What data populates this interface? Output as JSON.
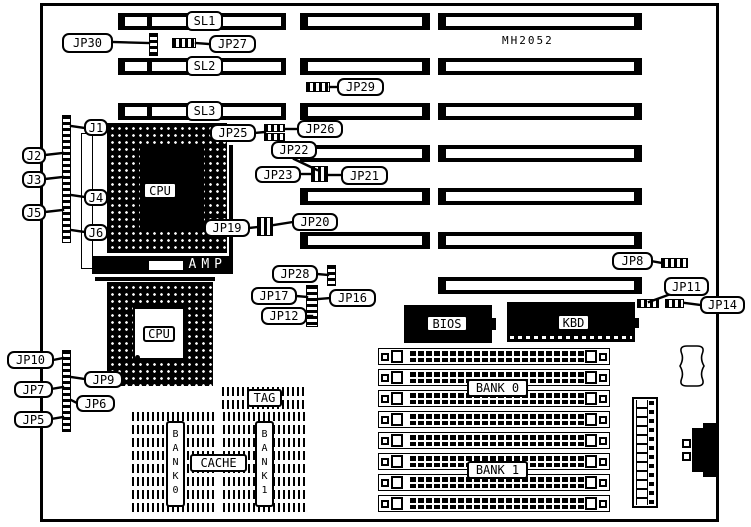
{
  "chips": {
    "model": "MH2052",
    "cpu1": "CPU",
    "cpu2": "CPU",
    "amp": "AMP",
    "bios": "BIOS",
    "kbd": "KBD",
    "tag": "TAG",
    "cache": "CACHE",
    "bank0_cache": "BANK0",
    "bank1_cache": "BANK1",
    "bank0_mem": "BANK 0",
    "bank1_mem": "BANK 1"
  },
  "diagram": {
    "slots": {
      "vlb": {
        "x": 118,
        "w": 168,
        "h": 17,
        "rows": [
          13,
          58,
          103
        ],
        "labels": [
          "SL1",
          "SL2",
          "SL3"
        ],
        "label_x": 186
      },
      "mid": {
        "x": 300,
        "w": 130,
        "h": 17,
        "rows": [
          13,
          58,
          103,
          145,
          188,
          232
        ]
      },
      "right": {
        "x": 438,
        "w": 204,
        "h": 17,
        "rows": [
          13,
          58,
          103,
          145,
          188,
          232,
          277
        ]
      }
    },
    "simms": {
      "x": 378,
      "w": 232,
      "h": 17,
      "rows": [
        348,
        369,
        390,
        411,
        432,
        453,
        474,
        495
      ]
    },
    "jumpers": [
      {
        "id": "jp30",
        "x": 149,
        "y": 33,
        "w": 9,
        "h": 23,
        "dir": "v"
      },
      {
        "id": "jp27",
        "x": 172,
        "y": 38,
        "w": 24,
        "h": 10,
        "dir": "h"
      },
      {
        "id": "jp29",
        "x": 306,
        "y": 82,
        "w": 24,
        "h": 10,
        "dir": "h"
      },
      {
        "id": "jp25-jp26-a",
        "x": 264,
        "y": 124,
        "w": 21,
        "h": 8,
        "dir": "h"
      },
      {
        "id": "jp25-jp26-b",
        "x": 264,
        "y": 133,
        "w": 21,
        "h": 8,
        "dir": "h"
      },
      {
        "id": "jp23-jp21",
        "x": 311,
        "y": 166,
        "w": 17,
        "h": 16,
        "dir": "h"
      },
      {
        "id": "jp19-jp20",
        "x": 257,
        "y": 217,
        "w": 16,
        "h": 19,
        "dir": "h"
      },
      {
        "id": "jp28",
        "x": 327,
        "y": 265,
        "w": 9,
        "h": 21,
        "dir": "v"
      },
      {
        "id": "jp17-jp16-jp12",
        "x": 306,
        "y": 285,
        "w": 12,
        "h": 42,
        "dir": "v"
      },
      {
        "id": "jp8",
        "x": 661,
        "y": 258,
        "w": 27,
        "h": 10,
        "dir": "h"
      },
      {
        "id": "jp11",
        "x": 637,
        "y": 299,
        "w": 22,
        "h": 9,
        "dir": "h"
      },
      {
        "id": "jp14",
        "x": 665,
        "y": 299,
        "w": 19,
        "h": 9,
        "dir": "h"
      },
      {
        "id": "j-header-column",
        "x": 62,
        "y": 115,
        "w": 9,
        "h": 128,
        "dir": "v"
      },
      {
        "id": "jp-header-column",
        "x": 62,
        "y": 350,
        "w": 9,
        "h": 82,
        "dir": "v"
      }
    ],
    "callouts": [
      {
        "text": "JP30",
        "x": 62,
        "y": 33,
        "w": 51,
        "h": 20
      },
      {
        "text": "JP27",
        "x": 209,
        "y": 35,
        "w": 47,
        "h": 18
      },
      {
        "text": "JP29",
        "x": 337,
        "y": 78,
        "w": 47,
        "h": 18
      },
      {
        "text": "JP26",
        "x": 297,
        "y": 120,
        "w": 46,
        "h": 18
      },
      {
        "text": "JP25",
        "x": 210,
        "y": 124,
        "w": 46,
        "h": 18
      },
      {
        "text": "JP22",
        "x": 271,
        "y": 141,
        "w": 46,
        "h": 18
      },
      {
        "text": "JP23",
        "x": 255,
        "y": 166,
        "w": 46,
        "h": 17
      },
      {
        "text": "JP21",
        "x": 341,
        "y": 166,
        "w": 47,
        "h": 19
      },
      {
        "text": "JP19",
        "x": 204,
        "y": 219,
        "w": 46,
        "h": 18
      },
      {
        "text": "JP20",
        "x": 292,
        "y": 213,
        "w": 46,
        "h": 18
      },
      {
        "text": "JP28",
        "x": 272,
        "y": 265,
        "w": 46,
        "h": 18
      },
      {
        "text": "JP17",
        "x": 251,
        "y": 287,
        "w": 46,
        "h": 18
      },
      {
        "text": "JP16",
        "x": 329,
        "y": 289,
        "w": 47,
        "h": 18
      },
      {
        "text": "JP12",
        "x": 261,
        "y": 307,
        "w": 46,
        "h": 18
      },
      {
        "text": "JP8",
        "x": 612,
        "y": 252,
        "w": 41,
        "h": 18
      },
      {
        "text": "JP11",
        "x": 664,
        "y": 277,
        "w": 45,
        "h": 19
      },
      {
        "text": "JP14",
        "x": 700,
        "y": 296,
        "w": 45,
        "h": 18
      },
      {
        "text": "J1",
        "x": 84,
        "y": 119,
        "w": 24,
        "h": 17
      },
      {
        "text": "J2",
        "x": 22,
        "y": 147,
        "w": 24,
        "h": 17
      },
      {
        "text": "J3",
        "x": 22,
        "y": 171,
        "w": 24,
        "h": 17
      },
      {
        "text": "J4",
        "x": 84,
        "y": 189,
        "w": 24,
        "h": 17
      },
      {
        "text": "J5",
        "x": 22,
        "y": 204,
        "w": 24,
        "h": 17
      },
      {
        "text": "J6",
        "x": 84,
        "y": 224,
        "w": 24,
        "h": 17
      },
      {
        "text": "JP10",
        "x": 7,
        "y": 351,
        "w": 47,
        "h": 18
      },
      {
        "text": "JP9",
        "x": 84,
        "y": 371,
        "w": 39,
        "h": 17
      },
      {
        "text": "JP7",
        "x": 14,
        "y": 381,
        "w": 39,
        "h": 17
      },
      {
        "text": "JP6",
        "x": 76,
        "y": 395,
        "w": 39,
        "h": 17
      },
      {
        "text": "JP5",
        "x": 14,
        "y": 411,
        "w": 39,
        "h": 17
      }
    ],
    "tails": [
      [
        112,
        42,
        149,
        43
      ],
      [
        209,
        44,
        196,
        43
      ],
      [
        338,
        87,
        330,
        87
      ],
      [
        298,
        129,
        286,
        129
      ],
      [
        255,
        133,
        265,
        132
      ],
      [
        294,
        159,
        317,
        170
      ],
      [
        300,
        174,
        312,
        174
      ],
      [
        342,
        175,
        329,
        175
      ],
      [
        249,
        228,
        258,
        227
      ],
      [
        293,
        222,
        274,
        225
      ],
      [
        317,
        274,
        328,
        275
      ],
      [
        296,
        296,
        307,
        297
      ],
      [
        330,
        298,
        319,
        299
      ],
      [
        306,
        316,
        312,
        316
      ],
      [
        651,
        261,
        662,
        263
      ],
      [
        668,
        295,
        649,
        302
      ],
      [
        701,
        305,
        685,
        303
      ],
      [
        85,
        128,
        71,
        126
      ],
      [
        45,
        155,
        63,
        153
      ],
      [
        45,
        179,
        63,
        177
      ],
      [
        85,
        197,
        71,
        195
      ],
      [
        45,
        212,
        63,
        210
      ],
      [
        85,
        232,
        71,
        230
      ],
      [
        53,
        360,
        63,
        358
      ],
      [
        85,
        379,
        71,
        377
      ],
      [
        51,
        389,
        63,
        387
      ],
      [
        77,
        403,
        71,
        400
      ],
      [
        51,
        419,
        63,
        417
      ]
    ]
  }
}
